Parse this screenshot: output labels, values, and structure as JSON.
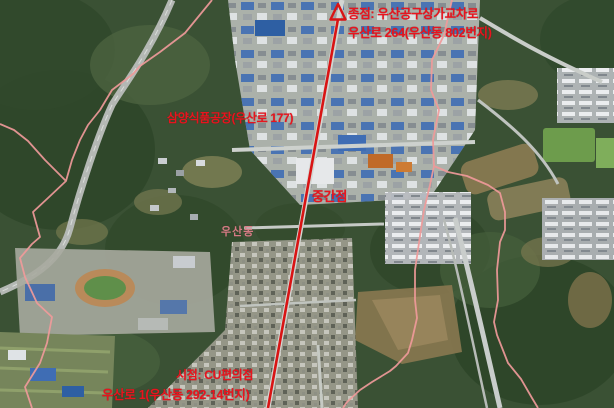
{
  "map": {
    "type": "satellite-route-map",
    "district_label": "우산동",
    "annotations": {
      "end_line1": "종점: 우산공구상가교차로",
      "end_line2": "우산로 264(우산동 802번지)",
      "factory": "삼양식품공장(우산로 177)",
      "midpoint": "중간점",
      "start_line1": "시점: CU편의점",
      "start_line2": "우산로 1(우산동 292-14번지)"
    },
    "colors": {
      "annotation_red": "#e8141e",
      "route_red": "#d91414",
      "boundary_pink": "#f09a9a",
      "forest_green": "#3a5134",
      "industrial_roof_blue": "#3f6db4"
    }
  }
}
